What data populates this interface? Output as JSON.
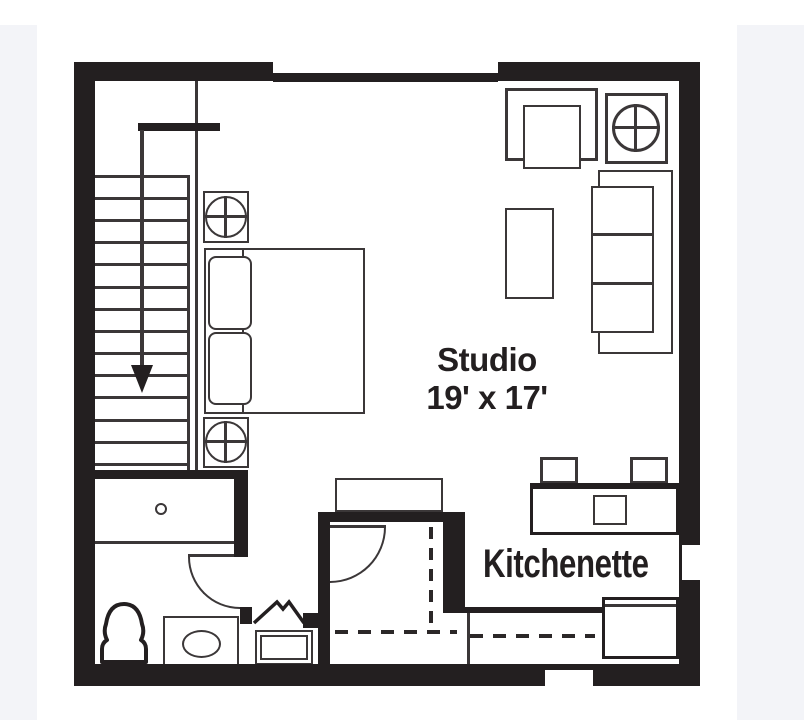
{
  "page": {
    "background_color": "#f3f4f8",
    "canvas_color": "#ffffff",
    "ink_color": "#231f20"
  },
  "floor_plan": {
    "studio": {
      "name": "Studio",
      "dimensions": "19' x 17'"
    },
    "kitchenette": {
      "label": "Kitchenette"
    }
  }
}
